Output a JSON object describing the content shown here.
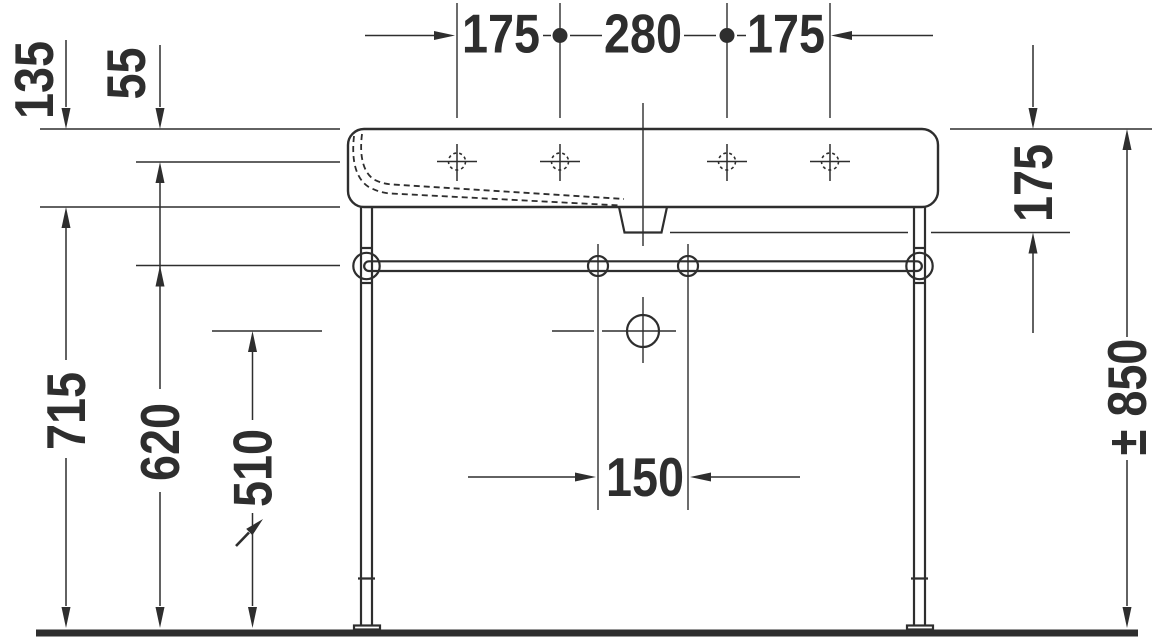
{
  "colors": {
    "ink": "#2e2e2e",
    "background": "#ffffff"
  },
  "dimensions": {
    "top_left": "175",
    "top_center": "280",
    "top_right": "175",
    "left_135": "135",
    "left_55": "55",
    "left_715": "715",
    "left_620": "620",
    "left_510": "510",
    "right_175": "175",
    "right_850": "± 850",
    "bottom_150": "150"
  }
}
